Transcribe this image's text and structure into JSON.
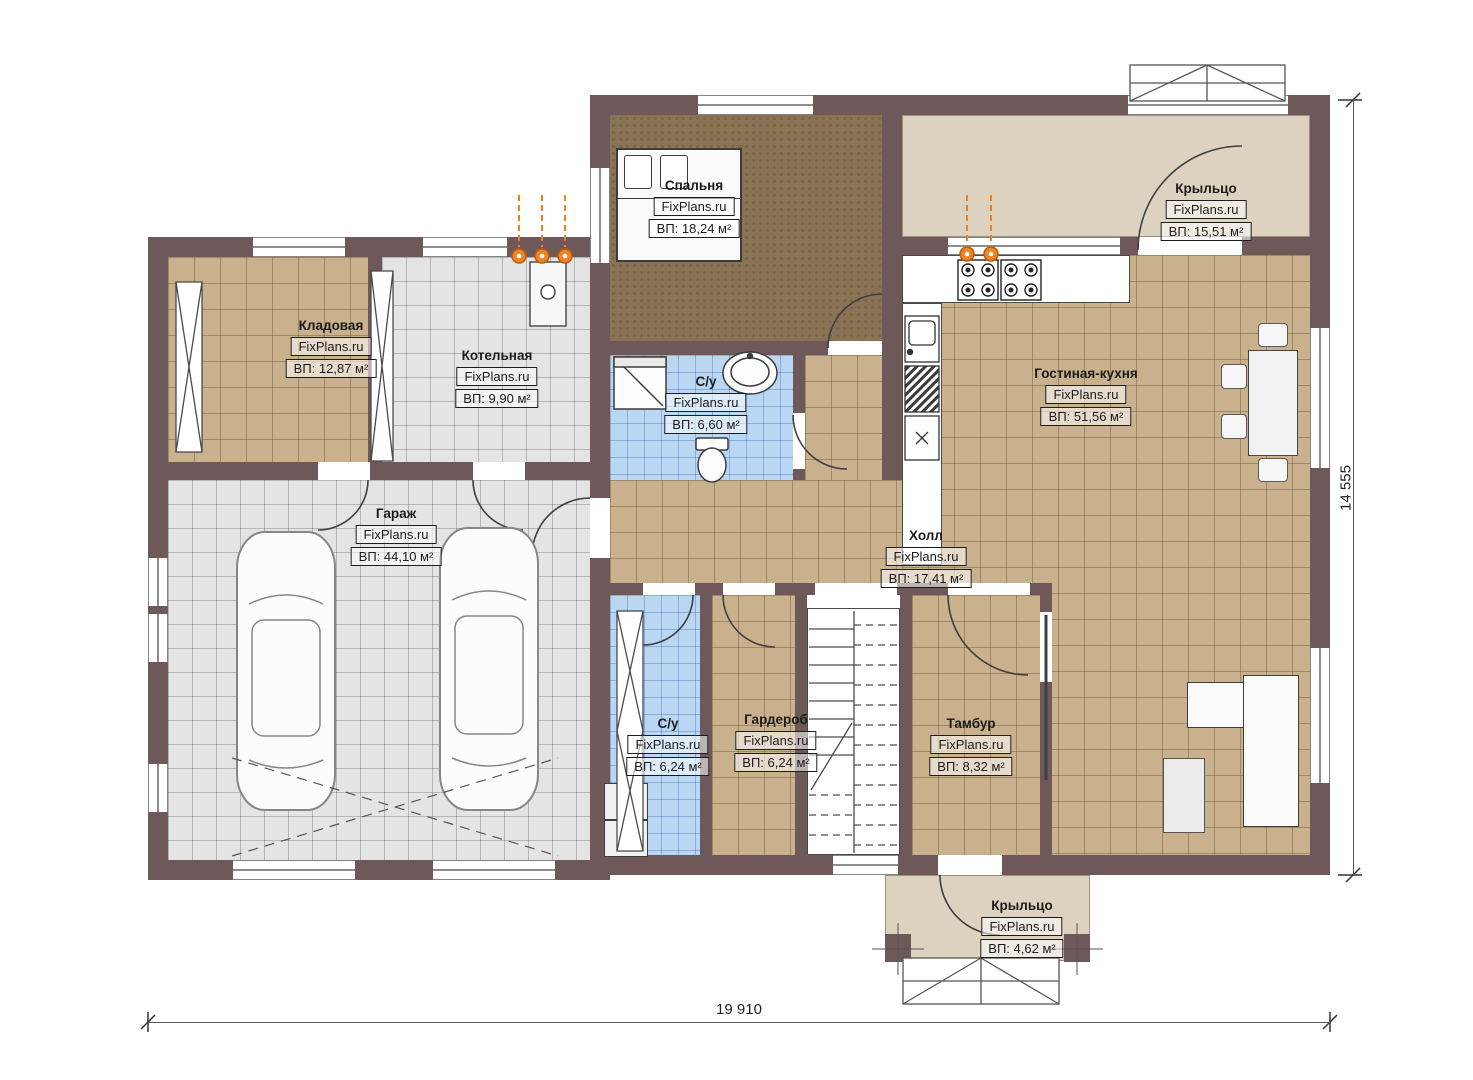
{
  "brand": "FixPlans.ru",
  "rooms": {
    "bedroom": {
      "name": "Спальня",
      "area": "ВП: 18,24 м²"
    },
    "storage": {
      "name": "Кладовая",
      "area": "ВП: 12,87 м²"
    },
    "boiler": {
      "name": "Котельная",
      "area": "ВП: 9,90 м²"
    },
    "bath_top": {
      "name": "С/у",
      "area": "ВП: 6,60 м²"
    },
    "living_kitchen": {
      "name": "Гостиная-кухня",
      "area": "ВП: 51,56 м²"
    },
    "porch_top": {
      "name": "Крыльцо",
      "area": "ВП: 15,51 м²"
    },
    "garage": {
      "name": "Гараж",
      "area": "ВП: 44,10 м²"
    },
    "hall": {
      "name": "Холл",
      "area": "ВП: 17,41 м²"
    },
    "bath_bottom": {
      "name": "С/у",
      "area": "ВП: 6,24 м²"
    },
    "wardrobe": {
      "name": "Гардероб",
      "area": "ВП: 6,24 м²"
    },
    "vestibule": {
      "name": "Тамбур",
      "area": "ВП: 8,32 м²"
    },
    "porch_bottom": {
      "name": "Крыльцо",
      "area": "ВП: 4,62 м²"
    }
  },
  "appliances": {
    "dryer": "СШ",
    "washer": "Ст.М."
  },
  "dimensions": {
    "width": "19 910",
    "height": "14 555"
  },
  "colors": {
    "wall": "#6e585a",
    "tile_tan": "#c9b18d",
    "tile_gray": "#e4e4e4",
    "tile_blue": "#b9d6f3",
    "bedroom_floor": "#8a7254",
    "porch_floor": "#ddd2bf",
    "accent_orange": "#ee7f24"
  }
}
